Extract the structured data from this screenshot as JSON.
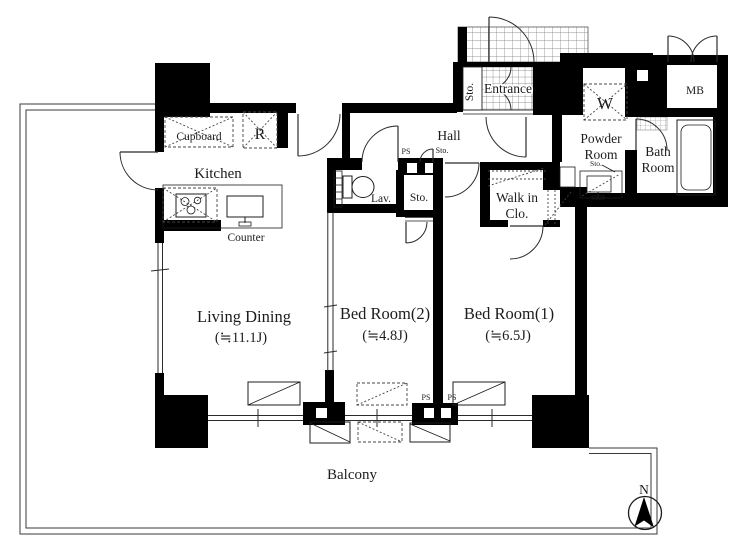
{
  "page": {
    "title": "Apartment floor plan"
  },
  "rooms": {
    "living_dining": {
      "name": "Living Dining",
      "size": "(≒11.1J)"
    },
    "bed_room_1": {
      "name": "Bed Room(1)",
      "size": "(≒6.5J)"
    },
    "bed_room_2": {
      "name": "Bed Room(2)",
      "size": "(≒4.8J)"
    },
    "kitchen": {
      "name": "Kitchen"
    },
    "hall": {
      "name": "Hall"
    },
    "entrance": {
      "name": "Entrance"
    },
    "balcony": {
      "name": "Balcony"
    },
    "powder_room": {
      "line1": "Powder",
      "line2": "Room"
    },
    "bath_room": {
      "line1": "Bath",
      "line2": "Room"
    },
    "walk_in_closet": {
      "line1": "Walk in",
      "line2": "Clo."
    },
    "lavatory": {
      "name": "Lav."
    }
  },
  "fixtures": {
    "cupboard": "Cupboard",
    "refrigerator": "R",
    "counter": "Counter",
    "meter_box": "MB",
    "washer": "W"
  },
  "storage": {
    "entrance_sto": "Sto.",
    "hall_sto": "Sto.",
    "bed2_sto": "Sto.",
    "powder_sto": "Sto."
  },
  "shafts": {
    "hall_ps": "PS",
    "bottom_ps_left": "PS",
    "bottom_ps_right": "PS"
  },
  "compass": {
    "north": "N"
  },
  "colors": {
    "wall": "#000000",
    "line": "#1c1c1c",
    "background": "#ffffff",
    "grid": "#888888"
  }
}
